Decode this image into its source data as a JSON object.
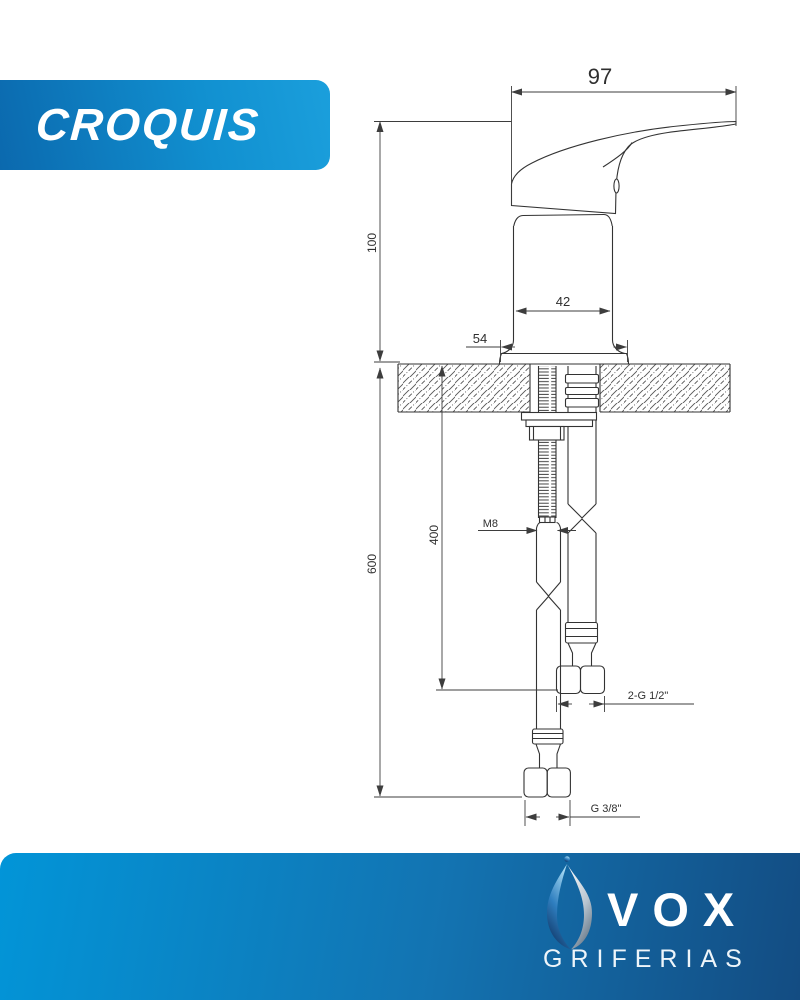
{
  "banner": {
    "title": "CROQUIS"
  },
  "drawing": {
    "dims": {
      "handle_length": "97",
      "body_height": "100",
      "cartridge_width": "42",
      "base_width": "54",
      "hose_length": "400",
      "total_height": "600",
      "stud_thread": "M8",
      "hose_thread": "2-G 1/2\"",
      "bottom_thread": "G 3/8\""
    }
  },
  "footer": {
    "brand": "VOX",
    "tagline": "GRIFERIAS"
  },
  "colors": {
    "banner_dark": "#0b69ae",
    "banner_light": "#1b9fdc",
    "footer_left": "#0295d8",
    "footer_right": "#134c82",
    "line": "#333333"
  }
}
